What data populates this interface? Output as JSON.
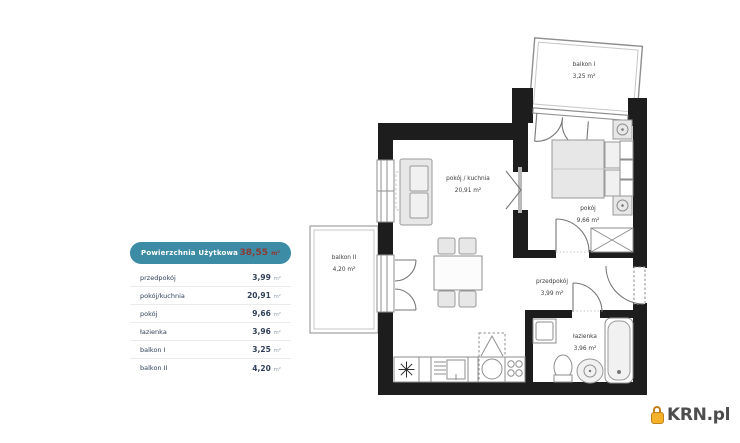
{
  "legend": {
    "title": "Powierzchnia Użytkowa",
    "total_value": "38,55",
    "total_unit": "m²",
    "rows": [
      {
        "label": "przedpokój",
        "value": "3,99",
        "unit": "m²"
      },
      {
        "label": "pokój/kuchnia",
        "value": "20,91",
        "unit": "m²"
      },
      {
        "label": "pokój",
        "value": "9,66",
        "unit": "m²"
      },
      {
        "label": "łazienka",
        "value": "3,96",
        "unit": "m²"
      },
      {
        "label": "balkon I",
        "value": "3,25",
        "unit": "m²"
      },
      {
        "label": "balkon II",
        "value": "4,20",
        "unit": "m²"
      }
    ]
  },
  "plan": {
    "rooms": {
      "living": {
        "name": "pokój / kuchnia",
        "area": "20,91 m²"
      },
      "bedroom": {
        "name": "pokój",
        "area": "9,66 m²"
      },
      "hall": {
        "name": "przedpokój",
        "area": "3,99 m²"
      },
      "bathroom": {
        "name": "łazienka",
        "area": "3,96 m²"
      },
      "balcony1": {
        "name": "balkon I",
        "area": "3,25 m²"
      },
      "balcony2": {
        "name": "balkon II",
        "area": "4,20 m²"
      }
    }
  },
  "logo": {
    "text": "KRN.pl"
  },
  "colors": {
    "accent_teal": "#3d8ca6",
    "total_text": "#8e3a33",
    "wall": "#1d1d1d",
    "logo_yellow": "#f3b229"
  }
}
